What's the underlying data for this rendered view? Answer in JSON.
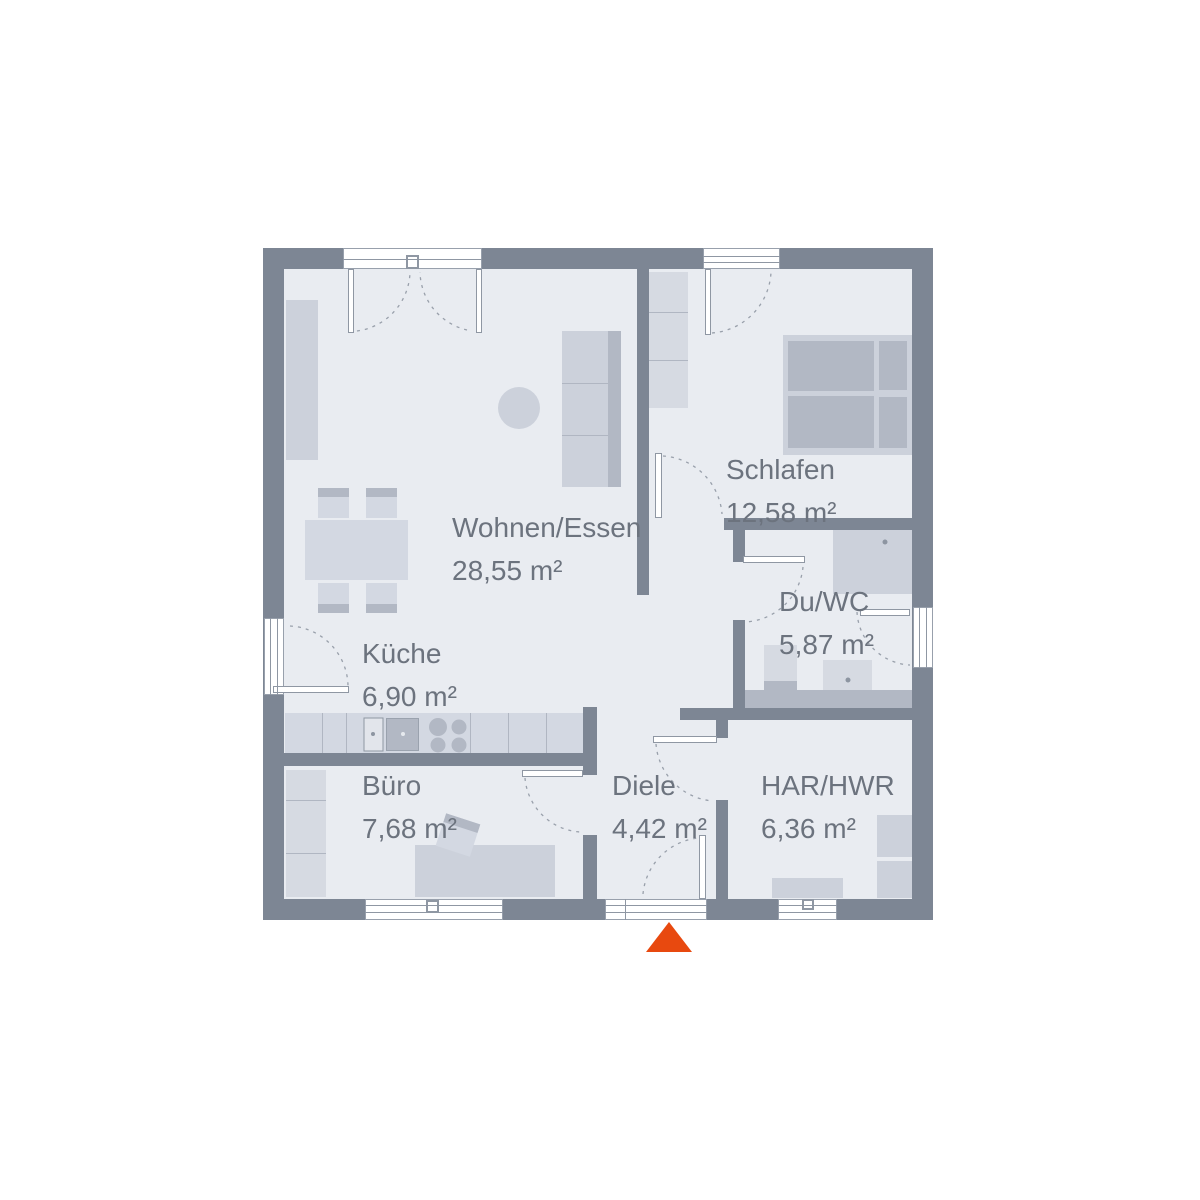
{
  "plan": {
    "type": "floorplan",
    "rooms": [
      {
        "id": "wohnen-essen",
        "name": "Wohnen/Essen",
        "area": "28,55 m²"
      },
      {
        "id": "schlafen",
        "name": "Schlafen",
        "area": "12,58 m²"
      },
      {
        "id": "du-wc",
        "name": "Du/WC",
        "area": "5,87 m²"
      },
      {
        "id": "kueche",
        "name": "Küche",
        "area": "6,90 m²"
      },
      {
        "id": "buero",
        "name": "Büro",
        "area": "7,68 m²"
      },
      {
        "id": "diele",
        "name": "Diele",
        "area": "4,42 m²"
      },
      {
        "id": "har-hwr",
        "name": "HAR/HWR",
        "area": "6,36 m²"
      }
    ],
    "entrance_marker": "orange-triangle-at-front-door",
    "colors": {
      "wall": "#7d8694",
      "floor": "#e9ecf1",
      "furniture_light": "#d3d8e2",
      "furniture_dark": "#b2b8c4",
      "label_text": "#6c737e",
      "accent_entrance": "#e8490f"
    }
  }
}
